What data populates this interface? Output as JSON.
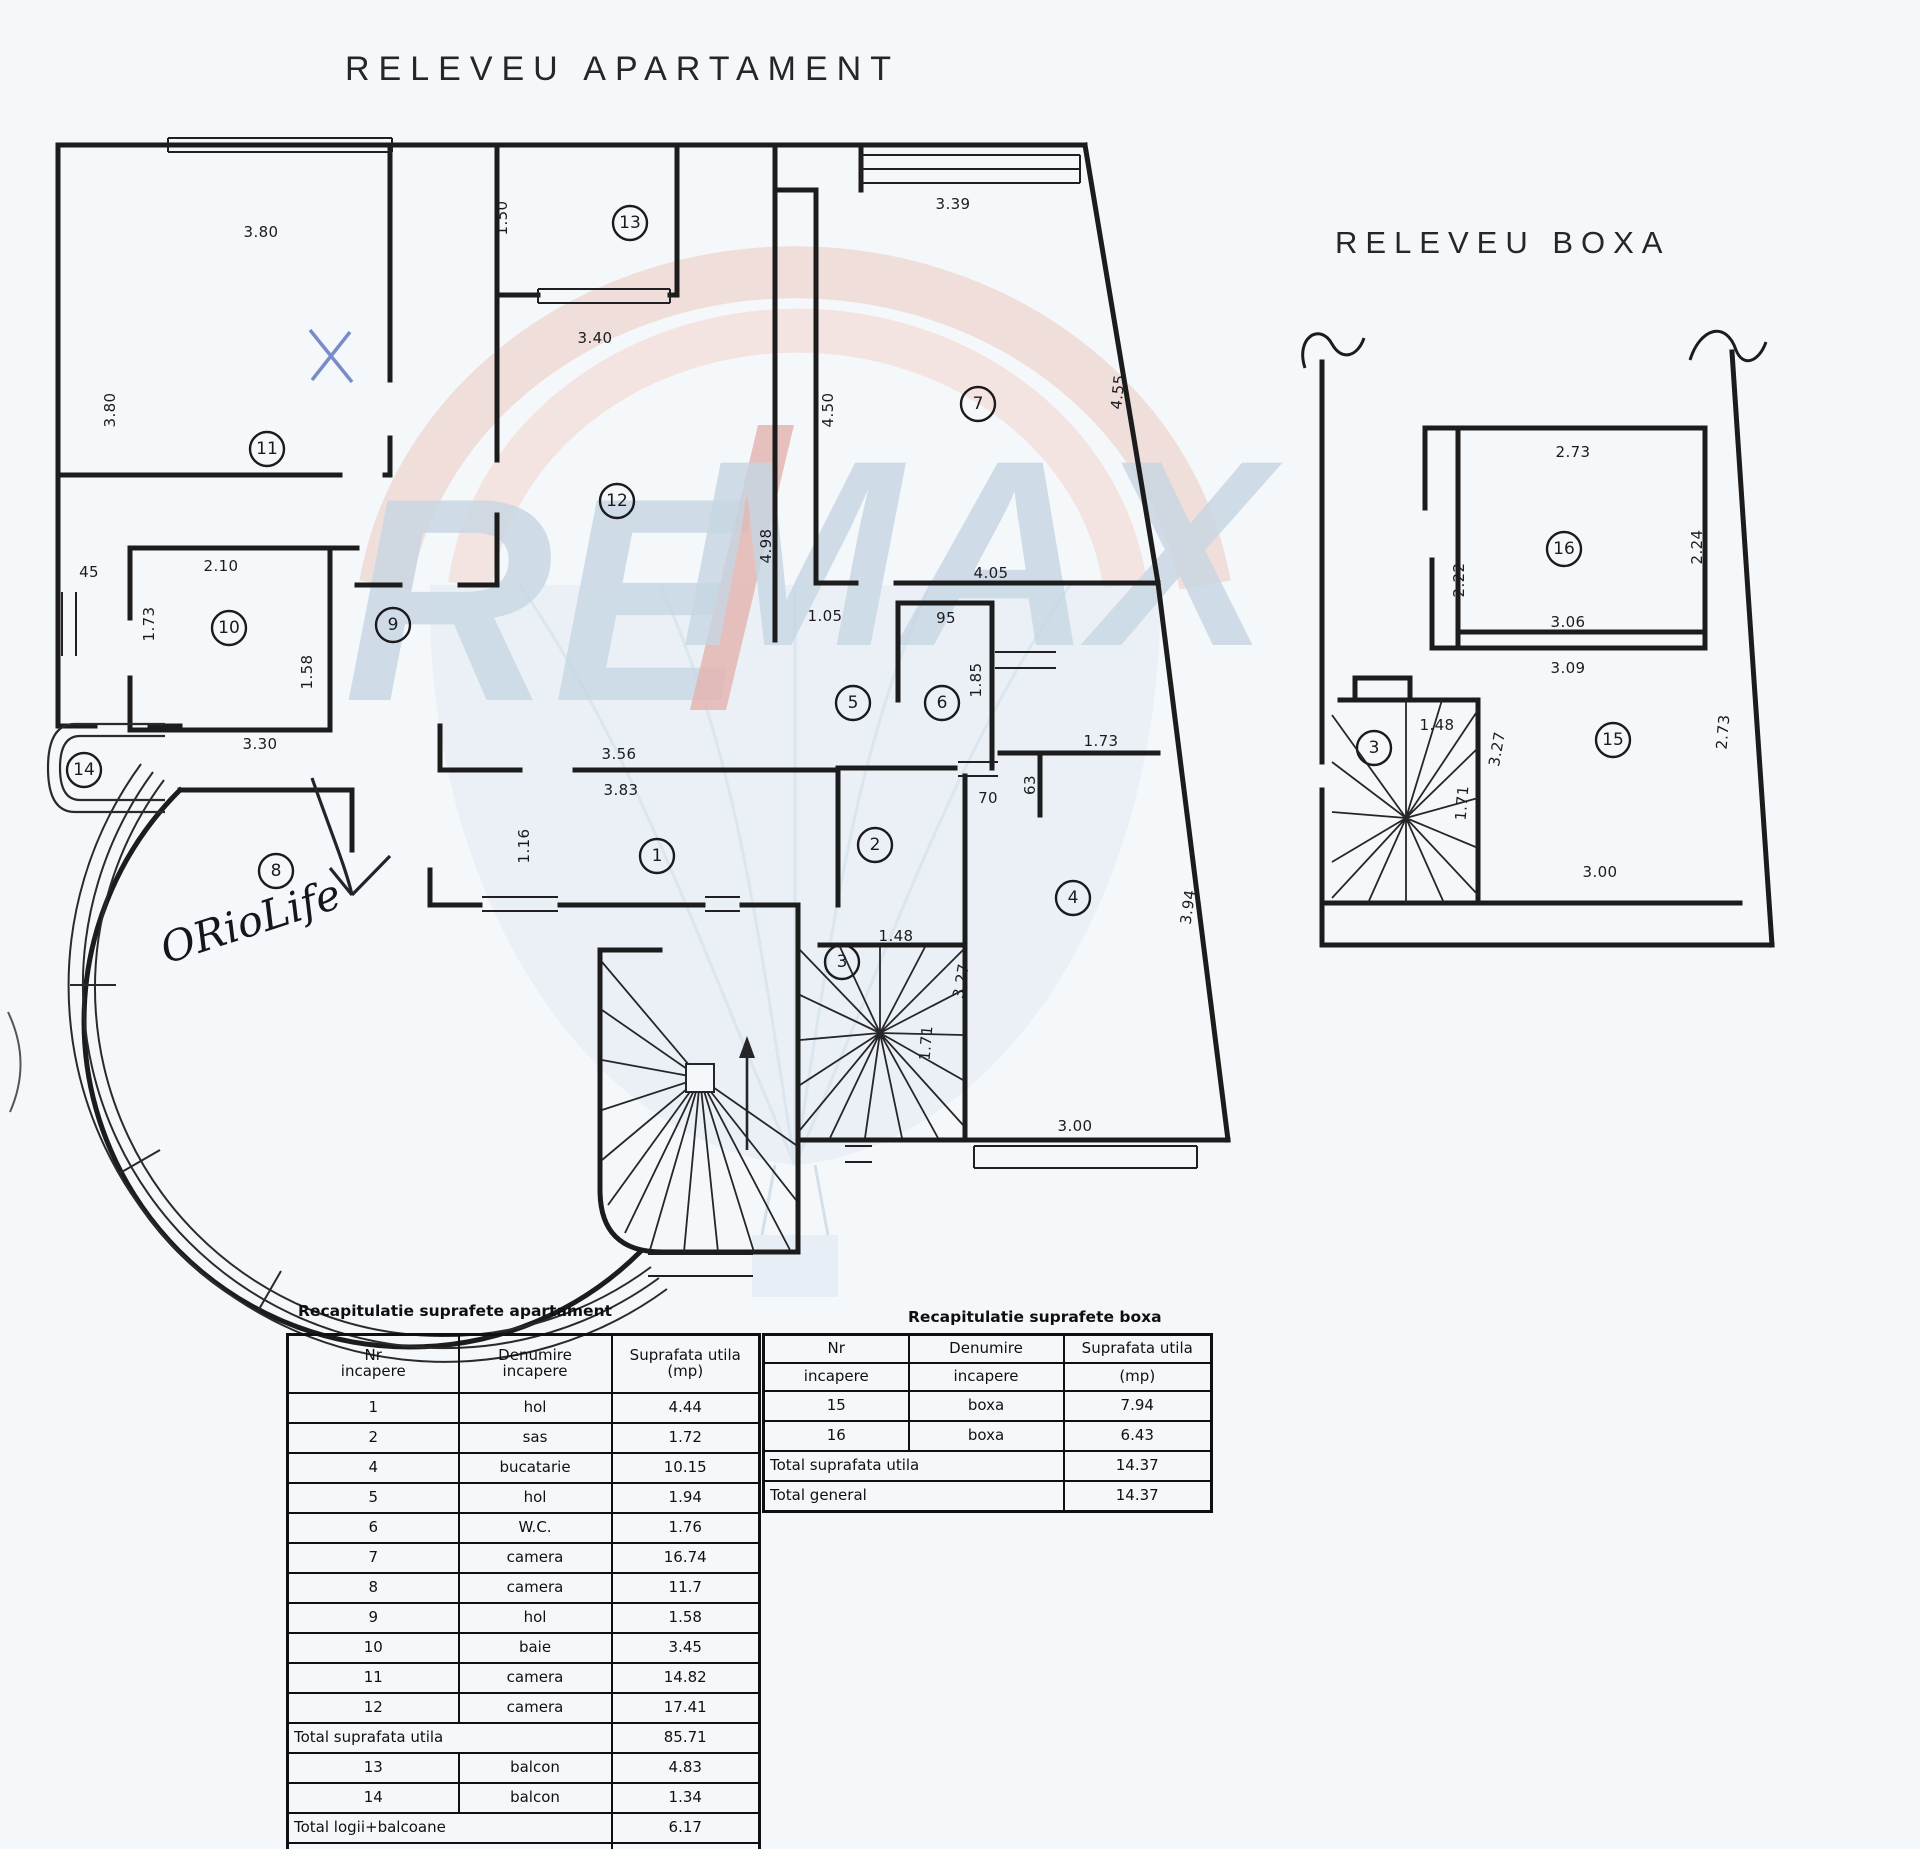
{
  "page": {
    "background": "#f5f8fa",
    "ink": "#1c1c1c"
  },
  "titles": {
    "apartment": "RELEVEU APARTAMENT",
    "boxa": "RELEVEU BOXA"
  },
  "watermark": {
    "left": "RE",
    "slash": "/",
    "right": "MAX",
    "letter_color": "#b7cbdb",
    "slash_color": "#dd9c93",
    "balloon_pink": "#eed6d1",
    "balloon_blue": "#dce6ef"
  },
  "annotations": {
    "handwriting": "ORioLife",
    "x_mark_color": "#6b7fc4",
    "pen_color": "#23232b"
  },
  "apartment_plan": {
    "rooms": [
      {
        "n": "11",
        "x": 267,
        "y": 449
      },
      {
        "n": "13",
        "x": 630,
        "y": 223
      },
      {
        "n": "7",
        "x": 978,
        "y": 404
      },
      {
        "n": "12",
        "x": 617,
        "y": 501
      },
      {
        "n": "10",
        "x": 229,
        "y": 628
      },
      {
        "n": "9",
        "x": 393,
        "y": 625
      },
      {
        "n": "5",
        "x": 853,
        "y": 703
      },
      {
        "n": "6",
        "x": 942,
        "y": 703
      },
      {
        "n": "14",
        "x": 84,
        "y": 770
      },
      {
        "n": "1",
        "x": 657,
        "y": 856
      },
      {
        "n": "2",
        "x": 875,
        "y": 845
      },
      {
        "n": "8",
        "x": 276,
        "y": 871
      },
      {
        "n": "3",
        "x": 842,
        "y": 962
      },
      {
        "n": "4",
        "x": 1073,
        "y": 898
      }
    ],
    "dims": [
      {
        "t": "3.80",
        "x": 261,
        "y": 232,
        "r": 0
      },
      {
        "t": "3.80",
        "x": 110,
        "y": 410,
        "r": -90
      },
      {
        "t": "1.50",
        "x": 502,
        "y": 218,
        "r": -90
      },
      {
        "t": "3.40",
        "x": 595,
        "y": 338,
        "r": 0
      },
      {
        "t": "3.39",
        "x": 953,
        "y": 204,
        "r": 0
      },
      {
        "t": "4.50",
        "x": 828,
        "y": 410,
        "r": -90
      },
      {
        "t": "4.55",
        "x": 1118,
        "y": 392,
        "r": -84
      },
      {
        "t": "4.98",
        "x": 766,
        "y": 546,
        "r": -90
      },
      {
        "t": "1.05",
        "x": 825,
        "y": 616,
        "r": 0
      },
      {
        "t": "4.05",
        "x": 991,
        "y": 573,
        "r": 0
      },
      {
        "t": "95",
        "x": 946,
        "y": 618,
        "r": 0
      },
      {
        "t": "1.85",
        "x": 976,
        "y": 680,
        "r": -90
      },
      {
        "t": "1.73",
        "x": 1101,
        "y": 741,
        "r": 0
      },
      {
        "t": "63",
        "x": 1030,
        "y": 785,
        "r": -90
      },
      {
        "t": "70",
        "x": 988,
        "y": 798,
        "r": 0
      },
      {
        "t": "3.56",
        "x": 619,
        "y": 754,
        "r": 0
      },
      {
        "t": "3.83",
        "x": 621,
        "y": 790,
        "r": 0
      },
      {
        "t": "2.10",
        "x": 221,
        "y": 566,
        "r": 0
      },
      {
        "t": "45",
        "x": 89,
        "y": 572,
        "r": 0
      },
      {
        "t": "1.73",
        "x": 149,
        "y": 624,
        "r": -90
      },
      {
        "t": "1.58",
        "x": 307,
        "y": 672,
        "r": -90
      },
      {
        "t": "3.30",
        "x": 260,
        "y": 744,
        "r": 0
      },
      {
        "t": "1.16",
        "x": 524,
        "y": 846,
        "r": -90
      },
      {
        "t": "1.48",
        "x": 896,
        "y": 936,
        "r": 0
      },
      {
        "t": "3.27",
        "x": 961,
        "y": 981,
        "r": -80
      },
      {
        "t": "1.71",
        "x": 926,
        "y": 1043,
        "r": -85
      },
      {
        "t": "3.00",
        "x": 1075,
        "y": 1126,
        "r": 0
      },
      {
        "t": "3.94",
        "x": 1188,
        "y": 907,
        "r": -82
      }
    ]
  },
  "boxa_plan": {
    "rooms": [
      {
        "n": "16",
        "x": 1564,
        "y": 549
      },
      {
        "n": "15",
        "x": 1613,
        "y": 740
      },
      {
        "n": "3",
        "x": 1374,
        "y": 748
      }
    ],
    "dims": [
      {
        "t": "2.73",
        "x": 1573,
        "y": 452,
        "r": 0
      },
      {
        "t": "2.24",
        "x": 1697,
        "y": 547,
        "r": -90
      },
      {
        "t": "2.22",
        "x": 1459,
        "y": 580,
        "r": -90
      },
      {
        "t": "3.06",
        "x": 1568,
        "y": 622,
        "r": 0
      },
      {
        "t": "3.09",
        "x": 1568,
        "y": 668,
        "r": 0
      },
      {
        "t": "1.48",
        "x": 1437,
        "y": 725,
        "r": 0
      },
      {
        "t": "3.27",
        "x": 1497,
        "y": 749,
        "r": -80
      },
      {
        "t": "1.71",
        "x": 1462,
        "y": 803,
        "r": -85
      },
      {
        "t": "2.73",
        "x": 1723,
        "y": 732,
        "r": -85
      },
      {
        "t": "3.00",
        "x": 1600,
        "y": 872,
        "r": 0
      }
    ]
  },
  "tables": {
    "apartment": {
      "title": "Recapitulatie suprafete apartament",
      "split_header": false,
      "headers": [
        [
          "Nr",
          "Denumire",
          "Suprafata utila"
        ],
        [
          "incapere",
          "incapere",
          "(mp)"
        ]
      ],
      "rows": [
        {
          "c": [
            "1",
            "hol",
            "4.44"
          ]
        },
        {
          "c": [
            "2",
            "sas",
            "1.72"
          ]
        },
        {
          "c": [
            "4",
            "bucatarie",
            "10.15"
          ]
        },
        {
          "c": [
            "5",
            "hol",
            "1.94"
          ]
        },
        {
          "c": [
            "6",
            "W.C.",
            "1.76"
          ]
        },
        {
          "c": [
            "7",
            "camera",
            "16.74"
          ]
        },
        {
          "c": [
            "8",
            "camera",
            "11.7"
          ]
        },
        {
          "c": [
            "9",
            "hol",
            "1.58"
          ]
        },
        {
          "c": [
            "10",
            "baie",
            "3.45"
          ]
        },
        {
          "c": [
            "11",
            "camera",
            "14.82"
          ]
        },
        {
          "c": [
            "12",
            "camera",
            "17.41"
          ]
        },
        {
          "span": "Total suprafata utila",
          "v": "85.71"
        },
        {
          "c": [
            "13",
            "balcon",
            "4.83"
          ]
        },
        {
          "c": [
            "14",
            "balcon",
            "1.34"
          ]
        },
        {
          "span": "Total logii+balcoane",
          "v": "6.17"
        },
        {
          "span": "Total general",
          "v": "91.88"
        }
      ]
    },
    "boxa": {
      "title": "Recapitulatie suprafete boxa",
      "split_header": true,
      "headers": [
        [
          "Nr",
          "Denumire",
          "Suprafata utila"
        ],
        [
          "incapere",
          "incapere",
          "(mp)"
        ]
      ],
      "rows": [
        {
          "c": [
            "15",
            "boxa",
            "7.94"
          ]
        },
        {
          "c": [
            "16",
            "boxa",
            "6.43"
          ]
        },
        {
          "span": "Total suprafata utila",
          "v": "14.37"
        },
        {
          "span": "Total general",
          "v": "14.37"
        }
      ]
    }
  }
}
